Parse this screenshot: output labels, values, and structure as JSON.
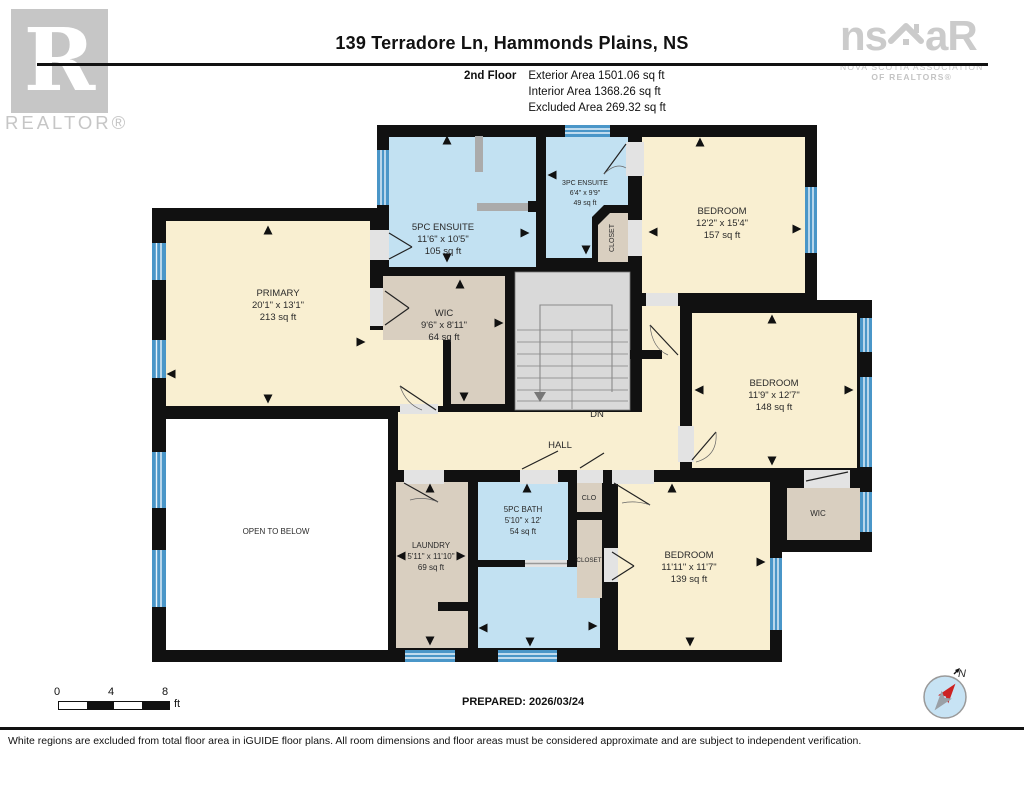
{
  "header": {
    "title": "139 Terradore Ln, Hammonds Plains, NS",
    "floor_label": "2nd Floor",
    "stats": [
      "Exterior Area 1501.06 sq ft",
      "Interior Area 1368.26 sq ft",
      "Excluded Area 269.32 sq ft"
    ]
  },
  "logos": {
    "realtor": {
      "letter": "R",
      "label": "REALTOR®"
    },
    "nsar": {
      "left": "ns",
      "right": "aR",
      "line1": "NOVA SCOTIA ASSOCIATION",
      "line2": "OF REALTORS®"
    }
  },
  "rooms": {
    "primary": {
      "name": "PRIMARY",
      "dims": "20'1\" x 13'1\"",
      "area": "213 sq ft"
    },
    "ensuite5": {
      "name": "5PC ENSUITE",
      "dims": "11'6\" x 10'5\"",
      "area": "105 sq ft"
    },
    "ensuite3": {
      "name": "3PC ENSUITE",
      "dims": "6'4\" x 9'9\"",
      "area": "49 sq ft"
    },
    "closet_top": {
      "name": "CLOSET"
    },
    "bedroom_top": {
      "name": "BEDROOM",
      "dims": "12'2\" x 15'4\"",
      "area": "157 sq ft"
    },
    "wic_center": {
      "name": "WIC",
      "dims": "9'6\" x 8'11\"",
      "area": "64 sq ft"
    },
    "bedroom_mid": {
      "name": "BEDROOM",
      "dims": "11'9\" x 12'7\"",
      "area": "148 sq ft"
    },
    "hall": {
      "name": "HALL",
      "stairs_label": "DN"
    },
    "open_below": {
      "name": "OPEN TO BELOW"
    },
    "laundry": {
      "name": "LAUNDRY",
      "dims": "5'11\" x 11'10\"",
      "area": "69 sq ft"
    },
    "bath5": {
      "name": "5PC BATH",
      "dims": "5'10\" x 12'",
      "area": "54 sq ft"
    },
    "clo": {
      "name": "CLO"
    },
    "closet_bath": {
      "name": "CLOSET"
    },
    "bedroom_bottom": {
      "name": "BEDROOM",
      "dims": "11'11\" x 11'7\"",
      "area": "139 sq ft"
    },
    "wic_bottom": {
      "name": "WIC"
    }
  },
  "scale_bar": {
    "ticks": [
      "0",
      "4",
      "8"
    ],
    "unit": "ft"
  },
  "prepared": "PREPARED: 2026/03/24",
  "compass": {
    "label": "N"
  },
  "footer": "White regions are excluded from total floor area in iGUIDE floor plans. All room dimensions and floor areas must be considered approximate and are subject to independent verification.",
  "colors": {
    "wall": "#111111",
    "room_fill": "#F9EFD1",
    "bath_fill": "#C2E1F2",
    "closet_fill": "#D9CFC0",
    "stairs_fill": "#D9D9D9",
    "window": "#4A96C8",
    "excluded": "#FFFFFF",
    "logo_gray": "#C6C6C6"
  }
}
